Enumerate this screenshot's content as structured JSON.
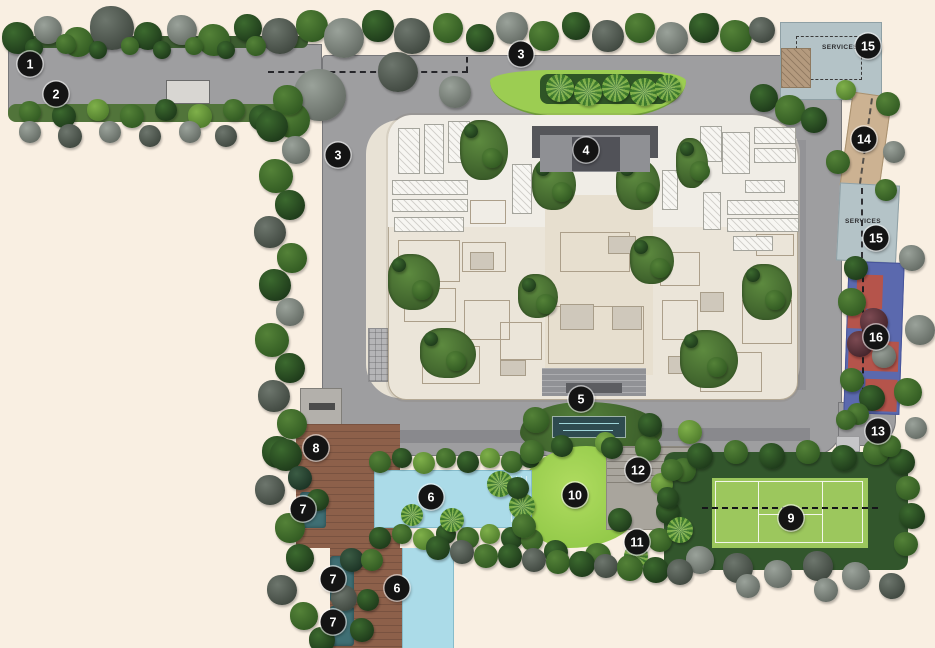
{
  "app": {
    "type": "residential-site-plan"
  },
  "labels": {
    "services_top": "SERVICES",
    "services_right": "SERVICES"
  },
  "markers": [
    {
      "label": "1",
      "x": 30,
      "y": 64
    },
    {
      "label": "2",
      "x": 56,
      "y": 94
    },
    {
      "label": "3",
      "x": 521,
      "y": 54
    },
    {
      "label": "3",
      "x": 338,
      "y": 155
    },
    {
      "label": "4",
      "x": 586,
      "y": 150
    },
    {
      "label": "5",
      "x": 581,
      "y": 399
    },
    {
      "label": "6",
      "x": 431,
      "y": 497
    },
    {
      "label": "6",
      "x": 397,
      "y": 588
    },
    {
      "label": "7",
      "x": 303,
      "y": 509
    },
    {
      "label": "7",
      "x": 333,
      "y": 579
    },
    {
      "label": "7",
      "x": 333,
      "y": 622
    },
    {
      "label": "8",
      "x": 316,
      "y": 448
    },
    {
      "label": "9",
      "x": 791,
      "y": 518
    },
    {
      "label": "10",
      "x": 575,
      "y": 495
    },
    {
      "label": "11",
      "x": 637,
      "y": 542
    },
    {
      "label": "12",
      "x": 638,
      "y": 470
    },
    {
      "label": "13",
      "x": 878,
      "y": 431
    },
    {
      "label": "14",
      "x": 864,
      "y": 139
    },
    {
      "label": "15",
      "x": 868,
      "y": 46
    },
    {
      "label": "15",
      "x": 876,
      "y": 238
    },
    {
      "label": "16",
      "x": 876,
      "y": 337
    }
  ],
  "colors": {
    "background": "#f9efe2",
    "road": "#9e9ea0",
    "building": "#ebe5d9",
    "pool": "#abdbe8",
    "lawn": "#9ed054",
    "tennis_court": "#9cc75d",
    "deck": "#8d604a",
    "services": "#b4c3c7",
    "playground_blue": "#5b69ae",
    "playground_red": "#b5544b",
    "marker": "#141414"
  }
}
